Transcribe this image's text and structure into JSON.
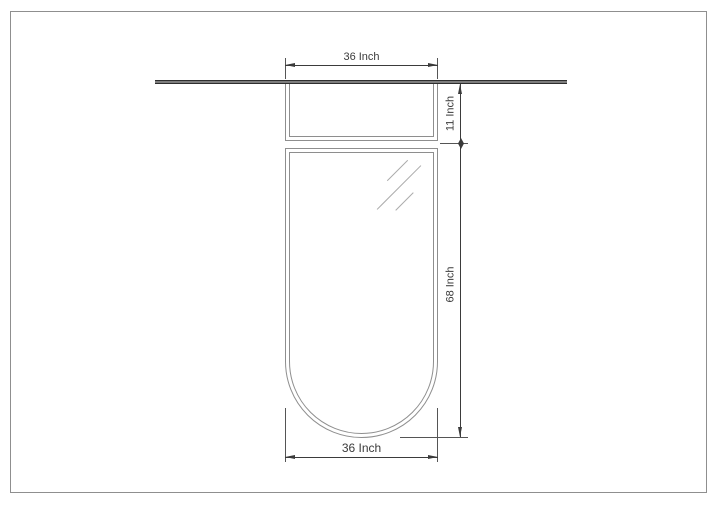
{
  "page": {
    "background": "#ffffff",
    "sheet_border_color": "#8f8f8f"
  },
  "drawing": {
    "type": "technical-drawing-elevation",
    "frame_line_color": "#8e8e8e",
    "dimension_color": "#3b3b3b",
    "glass_mark_color": "#ababab",
    "top_bar_color": "#2e2e2e"
  },
  "dimensions": {
    "top_width": "36 Inch",
    "upper_section_height": "11 Inch",
    "overall_height": "68 Inch",
    "bottom_width": "36 Inch"
  }
}
